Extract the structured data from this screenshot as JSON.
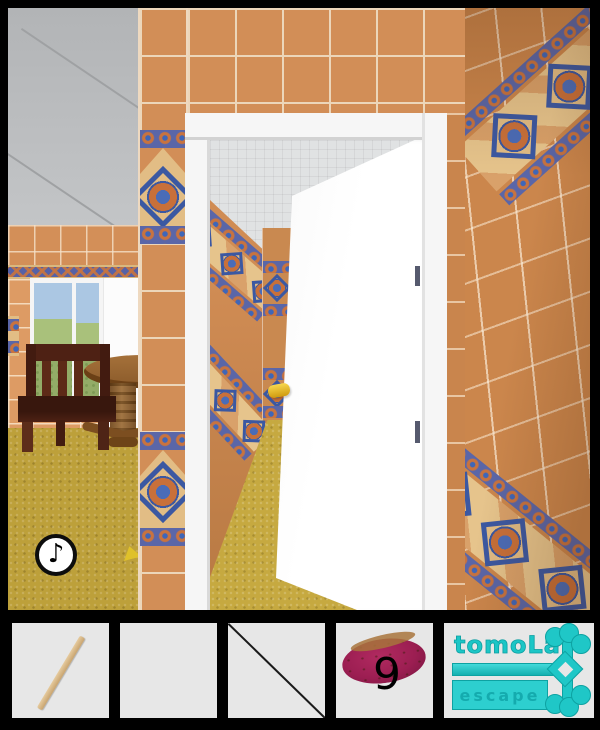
{
  "scene": {
    "description": "3D escape-room view: orange tiled hallway with open white door, side room with window, table and chair",
    "music_button": {
      "icon": "music-note-icon",
      "symbol": "♪"
    },
    "door": {
      "handle": "gold-lever"
    },
    "colors": {
      "tile_orange": "#d28e57",
      "deco_blue": "#5a66a8",
      "deco_tan": "#e2bd85",
      "carpet_gold": "#bda03a",
      "ceiling_gray": "#b7b9bb",
      "door_white": "#fbfbfb",
      "logo_cyan": "#1fc7c7"
    }
  },
  "inventory": {
    "slots": [
      {
        "name": "wooden-stick",
        "state": "filled",
        "count": ""
      },
      {
        "name": "empty",
        "state": "empty",
        "count": ""
      },
      {
        "name": "crossed-out",
        "state": "disabled",
        "count": ""
      },
      {
        "name": "sweet-potato",
        "state": "filled",
        "count": "9"
      },
      {
        "name": "logo-panel",
        "state": "logo",
        "count": ""
      }
    ]
  },
  "logo": {
    "title": "tomoLa",
    "subtitle": "escape"
  }
}
